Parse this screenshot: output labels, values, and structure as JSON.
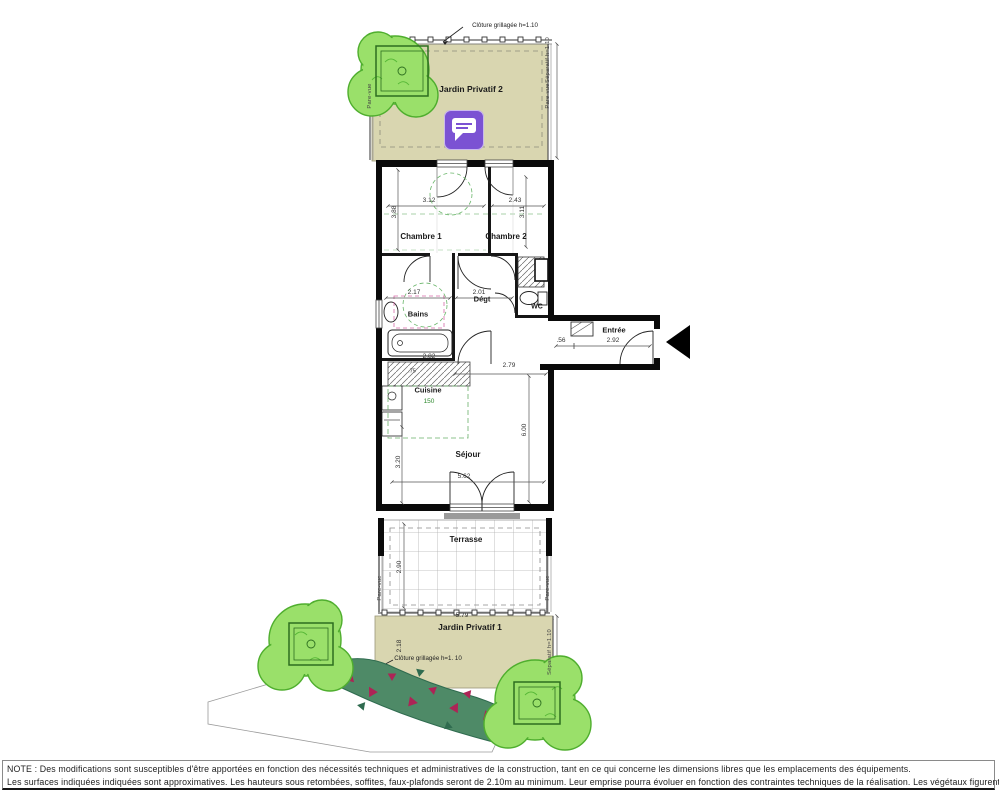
{
  "jardin2": {
    "label": "Jardin Privatif 2",
    "fence": "Clôture grillagée h=1.10",
    "separatif": "Séparatif h=1.10",
    "parevue_right": "Pare-vue",
    "parevue_left": "Pare-vue"
  },
  "jardin1": {
    "label": "Jardin Privatif 1",
    "fence": "Clôture grillagée h=1. 10",
    "separatif": "Séparatif h=1.10",
    "width": "5.79",
    "depth": "2.18"
  },
  "terrasse": {
    "label": "Terrasse",
    "depth": "2.90",
    "parevue_left": "Pare-vue",
    "parevue_right": "Pare-vue"
  },
  "chambre1": {
    "label": "Chambre 1",
    "width": "3.12",
    "depth": "3.88"
  },
  "chambre2": {
    "label": "Chambre 2",
    "width": "2.43",
    "depth": "3.11"
  },
  "bains": {
    "label": "Bains",
    "width": "2.17"
  },
  "degt": {
    "label": "Dégt",
    "width": "2.01"
  },
  "wc": {
    "label": "WC"
  },
  "entree": {
    "label": "Entrée",
    "dim_a": ".56",
    "dim_b": "2.92"
  },
  "cuisine": {
    "label": "Cuisine",
    "dim_a": "2.82",
    "dim_b": ".75",
    "dim_c": "150"
  },
  "sejour": {
    "label": "Séjour",
    "width": "5.62",
    "depth_right": "6.00",
    "depth_left": "3.20",
    "dim_top": "2.79"
  },
  "annotation": {
    "name": "comment-marker"
  },
  "colors": {
    "garden": "#d9d6b0",
    "tree": "#9ae06a",
    "tree_edge": "#4fae2e",
    "hedge": "#4e8a67",
    "flower": "#ad2456",
    "annotation": "#7b52d3",
    "wall": "#0a0a0a"
  },
  "note": {
    "line1": "NOTE :  Des modifications sont susceptibles d'être apportées en fonction des nécessités techniques et administratives de la construction, tant en ce qui concerne les dimensions libres que les emplacements des équipements.",
    "line2": "Les surfaces indiquées indiquées sont approximatives. Les hauteurs sous retombées, soffites, faux-plafonds seront de 2.10m au minimum. Leur emprise pourra évoluer en fonction des contraintes techniques de la réalisation. Les végétaux figurent à titre indicatif."
  }
}
